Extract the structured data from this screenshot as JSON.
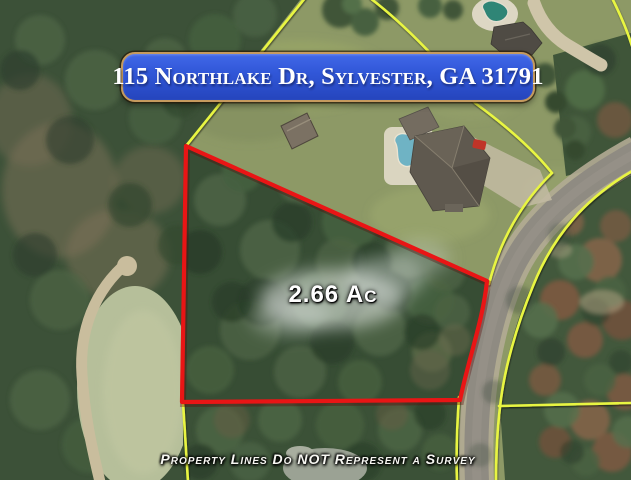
{
  "banner": {
    "address": "115 Northlake Dr, Sylvester, GA 31791",
    "background_color": "#3157d8",
    "border_color": "#c59a5e",
    "text_color": "#ffffff"
  },
  "property": {
    "acreage_label": "2.66 Ac",
    "boundary_color": "#e91515"
  },
  "map": {
    "imagery": "aerial-satellite-photo",
    "parcel_line_color": "#e8f542",
    "road_color": "#8f8b82"
  },
  "disclaimer": {
    "text": "Property Lines Do NOT Represent a Survey"
  }
}
